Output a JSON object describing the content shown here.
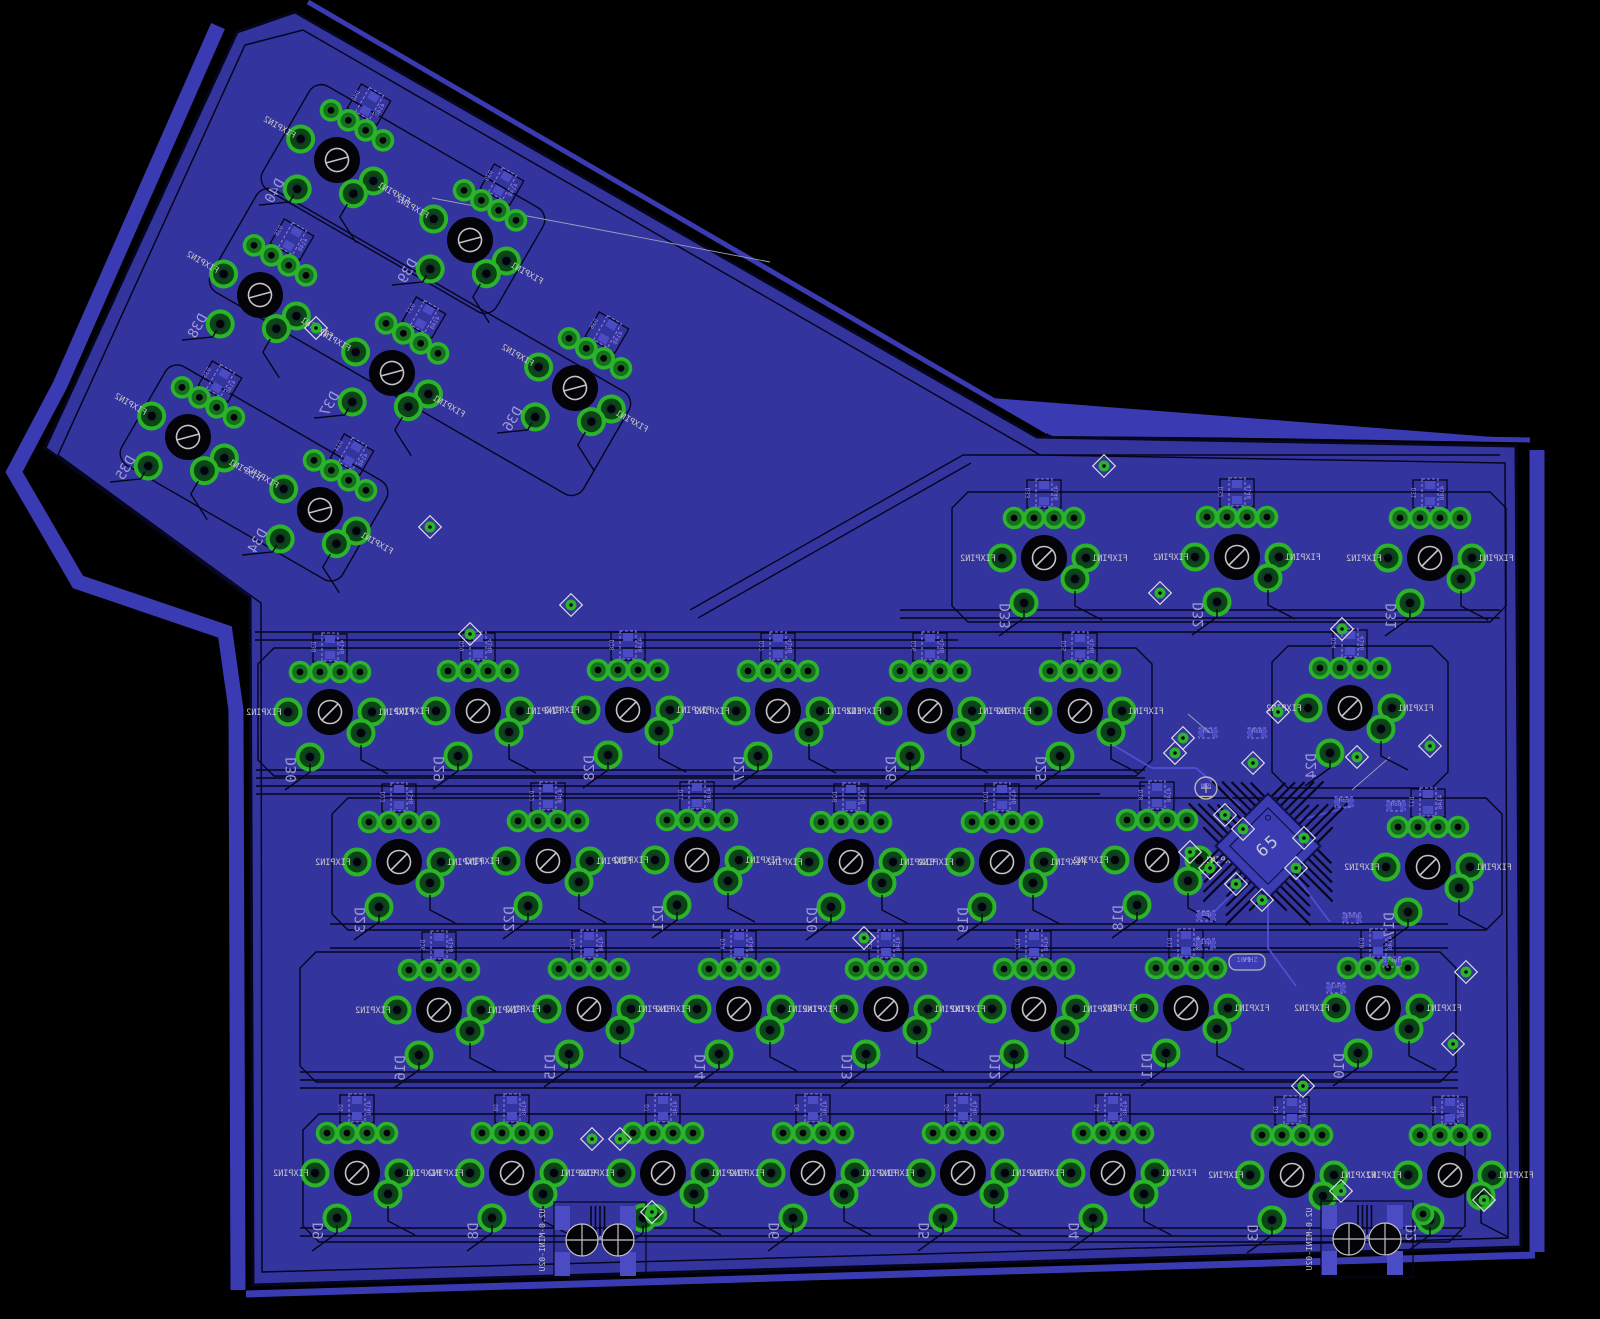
{
  "view": {
    "name": "pcb-board-layout-bottom-view",
    "board_description": "ergonomic keyboard PCB",
    "mcu_label": "65",
    "footprint_note": "MODSTRAY-SWITCH-ANSI-K.8X2.8MM"
  },
  "colors": {
    "background": "#000000",
    "board_fill": "#34349e",
    "dim_outline": "#3a3ab2",
    "gap": "#05051c",
    "smd_pad": "#4b4bc4",
    "trace_top": "#4f4fd2",
    "pad_ring": "#2bb32b",
    "pad_mid": "#156f1d",
    "pad_dark": "#0a4711",
    "pad_cross": "#8fe58f",
    "hole": "#030308",
    "silk": "#c6c6c6",
    "tname": "#8e84e6",
    "ref_label": "#9d99d6",
    "via_ring": "#dcdcdc",
    "mcu_edge": "#101048",
    "mcu_body": "#3b3bb2"
  },
  "labels": {
    "fixpin1": "FIXPIN1",
    "fixpin2": "FIXPIN2",
    "diode_value": "4148",
    "led_ref": "N63",
    "led_value": "12",
    "crystal_ref": "Y1",
    "crystal_value": "16MHZ"
  },
  "board": {
    "outline": [
      [
        295,
        12
      ],
      [
        1037,
        437
      ],
      [
        1516,
        446
      ],
      [
        1521,
        1247
      ],
      [
        253,
        1285
      ],
      [
        250,
        598
      ],
      [
        45,
        448
      ],
      [
        237,
        32
      ]
    ],
    "inset_outline": [
      [
        303,
        30
      ],
      [
        1040,
        455
      ],
      [
        1505,
        463
      ],
      [
        1508,
        1238
      ],
      [
        262,
        1272
      ],
      [
        261,
        603
      ],
      [
        58,
        455
      ],
      [
        245,
        45
      ]
    ],
    "dim_wedge": [
      [
        992,
        398
      ],
      [
        1532,
        440
      ],
      [
        1052,
        436
      ]
    ],
    "dim_band": [
      [
        218,
        26
      ],
      [
        60,
        385
      ],
      [
        14,
        472
      ],
      [
        78,
        582
      ],
      [
        225,
        632
      ],
      [
        236,
        710
      ],
      [
        238,
        1290
      ]
    ],
    "dim_lines": [
      {
        "pts": [
          [
            308,
            2
          ],
          [
            1048,
            432
          ]
        ],
        "w": 5
      },
      {
        "pts": [
          [
            1048,
            432
          ],
          [
            1530,
            440
          ]
        ],
        "w": 5
      },
      {
        "pts": [
          [
            1537,
            450
          ],
          [
            1537,
            1252
          ]
        ],
        "w": 15
      },
      {
        "pts": [
          [
            1535,
            1255
          ],
          [
            246,
            1294
          ]
        ],
        "w": 7
      }
    ]
  },
  "switches": [
    {
      "ref": "D40",
      "x": 337,
      "y": 160,
      "rot": 30
    },
    {
      "ref": "D39",
      "x": 470,
      "y": 240,
      "rot": 30
    },
    {
      "ref": "D38",
      "x": 260,
      "y": 295,
      "rot": 30
    },
    {
      "ref": "D37",
      "x": 392,
      "y": 373,
      "rot": 30
    },
    {
      "ref": "D36",
      "x": 575,
      "y": 388,
      "rot": 30
    },
    {
      "ref": "D35",
      "x": 188,
      "y": 437,
      "rot": 30
    },
    {
      "ref": "D34",
      "x": 320,
      "y": 510,
      "rot": 30
    },
    {
      "ref": "D33",
      "x": 1044,
      "y": 558,
      "rot": 0
    },
    {
      "ref": "D32",
      "x": 1237,
      "y": 557,
      "rot": 0
    },
    {
      "ref": "D31",
      "x": 1430,
      "y": 558,
      "rot": 0
    },
    {
      "ref": "D30",
      "x": 330,
      "y": 712,
      "rot": 0
    },
    {
      "ref": "D29",
      "x": 478,
      "y": 711,
      "rot": 0
    },
    {
      "ref": "D28",
      "x": 628,
      "y": 710,
      "rot": 0
    },
    {
      "ref": "D27",
      "x": 778,
      "y": 711,
      "rot": 0
    },
    {
      "ref": "D26",
      "x": 930,
      "y": 711,
      "rot": 0
    },
    {
      "ref": "D25",
      "x": 1080,
      "y": 711,
      "rot": 0
    },
    {
      "ref": "D24",
      "x": 1350,
      "y": 708,
      "rot": 0
    },
    {
      "ref": "D23",
      "x": 399,
      "y": 862,
      "rot": 0
    },
    {
      "ref": "D22",
      "x": 548,
      "y": 861,
      "rot": 0
    },
    {
      "ref": "D21",
      "x": 697,
      "y": 860,
      "rot": 0
    },
    {
      "ref": "D20",
      "x": 851,
      "y": 862,
      "rot": 0
    },
    {
      "ref": "D19",
      "x": 1002,
      "y": 862,
      "rot": 0
    },
    {
      "ref": "D18",
      "x": 1157,
      "y": 860,
      "rot": 0
    },
    {
      "ref": "D17",
      "x": 1428,
      "y": 867,
      "rot": 0
    },
    {
      "ref": "D16",
      "x": 439,
      "y": 1010,
      "rot": 0
    },
    {
      "ref": "D15",
      "x": 589,
      "y": 1009,
      "rot": 0
    },
    {
      "ref": "D14",
      "x": 739,
      "y": 1009,
      "rot": 0
    },
    {
      "ref": "D13",
      "x": 886,
      "y": 1009,
      "rot": 0
    },
    {
      "ref": "D12",
      "x": 1034,
      "y": 1009,
      "rot": 0
    },
    {
      "ref": "D11",
      "x": 1186,
      "y": 1008,
      "rot": 0
    },
    {
      "ref": "D10",
      "x": 1378,
      "y": 1008,
      "rot": 0
    },
    {
      "ref": "D9",
      "x": 357,
      "y": 1173,
      "rot": 0
    },
    {
      "ref": "D8",
      "x": 512,
      "y": 1173,
      "rot": 0
    },
    {
      "ref": "D7",
      "x": 663,
      "y": 1173,
      "rot": 0
    },
    {
      "ref": "D6",
      "x": 813,
      "y": 1173,
      "rot": 0
    },
    {
      "ref": "D5",
      "x": 963,
      "y": 1173,
      "rot": 0
    },
    {
      "ref": "D4",
      "x": 1113,
      "y": 1173,
      "rot": 0
    },
    {
      "ref": "D3",
      "x": 1292,
      "y": 1175,
      "rot": 0
    },
    {
      "ref": "D2",
      "x": 1450,
      "y": 1175,
      "rot": 0
    }
  ],
  "mcu": {
    "x": 1268,
    "y": 846,
    "rot": 45,
    "label": "65"
  },
  "led": {
    "x": 1206,
    "y": 788
  },
  "crystal": {
    "x": 1247,
    "y": 962
  },
  "connectors": [
    {
      "label": "U2.0-MINI-02U",
      "x": 600,
      "y": 1240,
      "pad_numbers": [
        "3",
        "4",
        "2",
        "1"
      ]
    },
    {
      "label": "U2.0-MINI-02U",
      "x": 1367,
      "y": 1239,
      "pad_numbers": [
        "3",
        "4",
        "2",
        "1"
      ]
    }
  ],
  "discretes": [
    {
      "name": "R68",
      "x": 1396,
      "y": 806
    },
    {
      "name": "R65",
      "x": 1344,
      "y": 802
    },
    {
      "name": "R61",
      "x": 1208,
      "y": 733
    },
    {
      "name": "R66",
      "x": 1257,
      "y": 733
    },
    {
      "name": "C5",
      "value": "16p",
      "x": 1206,
      "y": 916
    },
    {
      "name": "16p",
      "x": 1206,
      "y": 944
    },
    {
      "name": "100n",
      "x": 1352,
      "y": 918
    },
    {
      "name": "0.1uF",
      "x": 1392,
      "y": 962
    },
    {
      "name": "1uF",
      "x": 1336,
      "y": 988
    }
  ],
  "vias": [
    [
      430,
      527
    ],
    [
      316,
      328
    ],
    [
      470,
      634
    ],
    [
      571,
      605
    ],
    [
      1104,
      466
    ],
    [
      1160,
      593
    ],
    [
      1342,
      629
    ],
    [
      1357,
      757
    ],
    [
      1430,
      746
    ],
    [
      1183,
      738
    ],
    [
      1175,
      753
    ],
    [
      1253,
      763
    ],
    [
      1278,
      712
    ],
    [
      1225,
      815
    ],
    [
      1243,
      829
    ],
    [
      1190,
      852
    ],
    [
      1210,
      868
    ],
    [
      1236,
      884
    ],
    [
      1262,
      900
    ],
    [
      1296,
      868
    ],
    [
      1304,
      838
    ],
    [
      864,
      938
    ],
    [
      592,
      1139
    ],
    [
      620,
      1139
    ],
    [
      652,
      1212
    ],
    [
      1303,
      1086
    ],
    [
      1341,
      1191
    ],
    [
      1484,
      1200
    ],
    [
      1453,
      1044
    ],
    [
      1466,
      972
    ]
  ],
  "row_outlines": [
    {
      "x1": 952,
      "y1": 492,
      "x2": 1506,
      "y2": 622
    },
    {
      "x1": 258,
      "y1": 648,
      "x2": 1152,
      "y2": 776
    },
    {
      "x1": 1272,
      "y1": 646,
      "x2": 1448,
      "y2": 788
    },
    {
      "x1": 332,
      "y1": 798,
      "x2": 1502,
      "y2": 930
    },
    {
      "x1": 300,
      "y1": 952,
      "x2": 1456,
      "y2": 1082
    },
    {
      "x1": 303,
      "y1": 1114,
      "x2": 1465,
      "y2": 1242
    }
  ],
  "wing_outlines": [
    {
      "cx": 403,
      "cy": 199,
      "len": 270,
      "wid": 120,
      "rot": 30
    },
    {
      "cx": 420,
      "cy": 342,
      "len": 430,
      "wid": 118,
      "rot": 30
    },
    {
      "cx": 254,
      "cy": 473,
      "len": 255,
      "wid": 114,
      "rot": 30
    }
  ],
  "bus_lines": [
    [
      255,
      632,
      1345,
      632
    ],
    [
      255,
      640,
      958,
      640
    ],
    [
      256,
      770,
      1145,
      770
    ],
    [
      256,
      778,
      1145,
      778
    ],
    [
      256,
      786,
      1145,
      786
    ],
    [
      256,
      794,
      1100,
      794
    ],
    [
      900,
      610,
      1500,
      610
    ],
    [
      900,
      618,
      1500,
      618
    ],
    [
      330,
      924,
      1448,
      924
    ],
    [
      330,
      948,
      1448,
      948
    ],
    [
      300,
      1072,
      1458,
      1072
    ],
    [
      300,
      1080,
      1458,
      1080
    ],
    [
      300,
      1088,
      1458,
      1088
    ],
    [
      300,
      1228,
      1462,
      1228
    ],
    [
      300,
      1236,
      1462,
      1236
    ],
    [
      690,
      610,
      963,
      455
    ],
    [
      698,
      618,
      971,
      463
    ],
    [
      963,
      455,
      1500,
      455
    ]
  ],
  "airwires": [
    [
      432,
      198,
      770,
      262
    ],
    [
      1352,
      790,
      1390,
      757
    ],
    [
      1188,
      714,
      1210,
      733
    ]
  ],
  "top_traces": [
    [
      [
        1240,
        806
      ],
      [
        1196,
        768
      ],
      [
        1152,
        768
      ]
    ],
    [
      [
        1294,
        874
      ],
      [
        1330,
        922
      ]
    ],
    [
      [
        1300,
        820
      ],
      [
        1352,
        806
      ]
    ],
    [
      [
        1240,
        886
      ],
      [
        1206,
        920
      ]
    ],
    [
      [
        1268,
        884
      ],
      [
        1268,
        948
      ],
      [
        1296,
        986
      ]
    ],
    [
      [
        1152,
        768
      ],
      [
        1108,
        742
      ]
    ]
  ]
}
